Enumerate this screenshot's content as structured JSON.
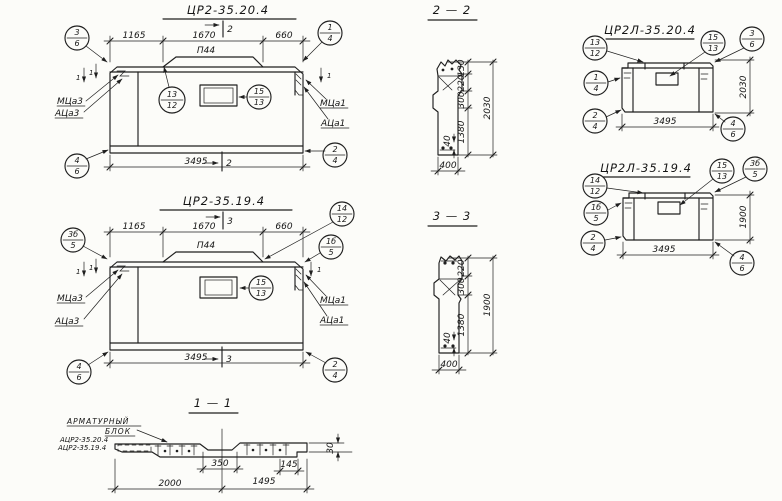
{
  "sheet": {
    "ink": "#1f1f1f",
    "paper": "#fcfcf9"
  },
  "front20": {
    "title": "ЦР2-35.20.4",
    "cut": "2",
    "sidecut": "1",
    "d1165": "1165",
    "d1670": "1670",
    "d660": "660",
    "d3495": "3495",
    "ledge": "П44",
    "b_tl_t": "3",
    "b_tl_b": "6",
    "b_tr_t": "1",
    "b_tr_b": "4",
    "b_bl_t": "4",
    "b_bl_b": "6",
    "b_br_t": "2",
    "b_br_b": "4",
    "b_mid_t": "13",
    "b_mid_b": "12",
    "b_hole_t": "15",
    "b_hole_b": "13",
    "lab_ml": "МЦа3",
    "lab_al": "АЦа3",
    "lab_mr": "МЦа1",
    "lab_ar": "АЦа1"
  },
  "front19": {
    "title": "ЦР2-35.19.4",
    "cut": "3",
    "sidecut": "1",
    "d1165": "1165",
    "d1670": "1670",
    "d660": "660",
    "d3495": "3495",
    "ledge": "П44",
    "b_tl_t": "3б",
    "b_tl_b": "5",
    "b_tr_t": "14",
    "b_tr_b": "12",
    "b_r_t": "1б",
    "b_r_b": "5",
    "b_bl_t": "4",
    "b_bl_b": "6",
    "b_br_t": "2",
    "b_br_b": "4",
    "b_hole_t": "15",
    "b_hole_b": "13",
    "lab_ml": "МЦа3",
    "lab_al": "АЦа3",
    "lab_mr": "МЦа1",
    "lab_ar": "АЦа1"
  },
  "sec22": {
    "title": "2 — 2",
    "d130": "130",
    "d220": "220",
    "d300": "300",
    "d1380": "1380",
    "d40": "40",
    "dtot": "2030",
    "dw": "400"
  },
  "sec33": {
    "title": "3 — 3",
    "d220": "220",
    "d300": "300",
    "d1380": "1380",
    "d40": "40",
    "dtot": "1900",
    "dw": "400"
  },
  "left20": {
    "title": "ЦР2Л-35.20.4",
    "b1_t": "13",
    "b1_b": "12",
    "b2_t": "15",
    "b2_b": "13",
    "b3_t": "3",
    "b3_b": "6",
    "b4_t": "1",
    "b4_b": "4",
    "b5_t": "2",
    "b5_b": "4",
    "b6_t": "4",
    "b6_b": "6",
    "dw": "3495",
    "dh": "2030"
  },
  "left19": {
    "title": "ЦР2Л-35.19.4",
    "b1_t": "14",
    "b1_b": "12",
    "b2_t": "15",
    "b2_b": "13",
    "b3_t": "3б",
    "b3_b": "5",
    "b4_t": "1б",
    "b4_b": "5",
    "b5_t": "2",
    "b5_b": "4",
    "b6_t": "4",
    "b6_b": "6",
    "dw": "3495",
    "dh": "1900"
  },
  "sec11": {
    "title": "1 — 1",
    "rebar1": "АРМАТУРНЫЙ",
    "rebar2": "БЛОК",
    "mark1": "АЦР2-35.20.4",
    "mark2": "АЦР2-35.19.4",
    "d350": "350",
    "d145": "145",
    "d2000": "2000",
    "d1495": "1495",
    "d30": "30"
  }
}
